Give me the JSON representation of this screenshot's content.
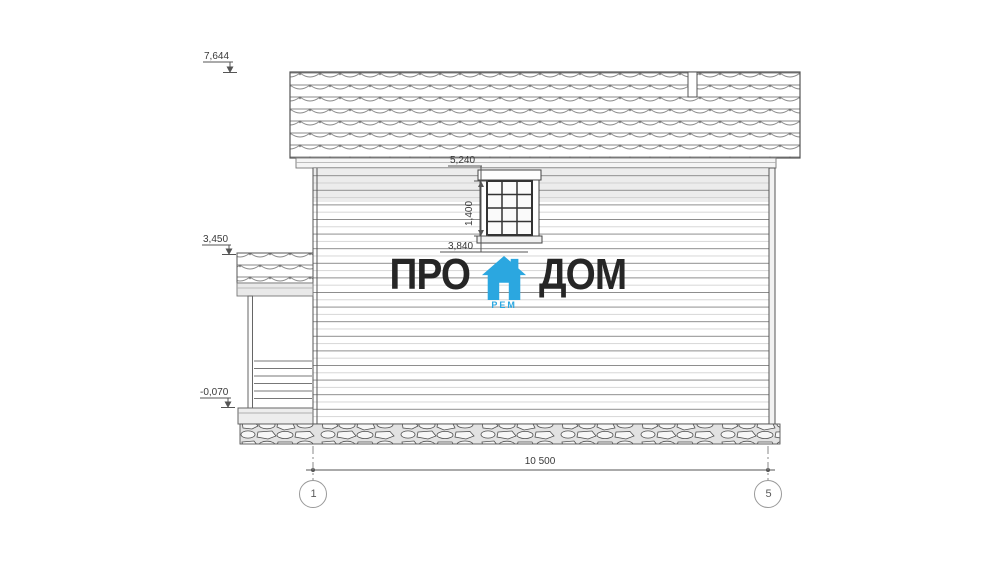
{
  "marks": {
    "roof_peak": "7,644",
    "porch_roof": "3,450",
    "ground": "-0,070",
    "window_top": "5,240",
    "window_height": "1,400",
    "window_sill": "3,840",
    "overall_width": "10 500"
  },
  "axes": {
    "left": "1",
    "right": "5"
  },
  "logo": {
    "pro": "ПРО",
    "dom": "ДОМ",
    "sub": "РЕМ"
  },
  "colors": {
    "accent_blue": "#2BA7E0",
    "logo_text": "#262626",
    "line": "#555555"
  }
}
